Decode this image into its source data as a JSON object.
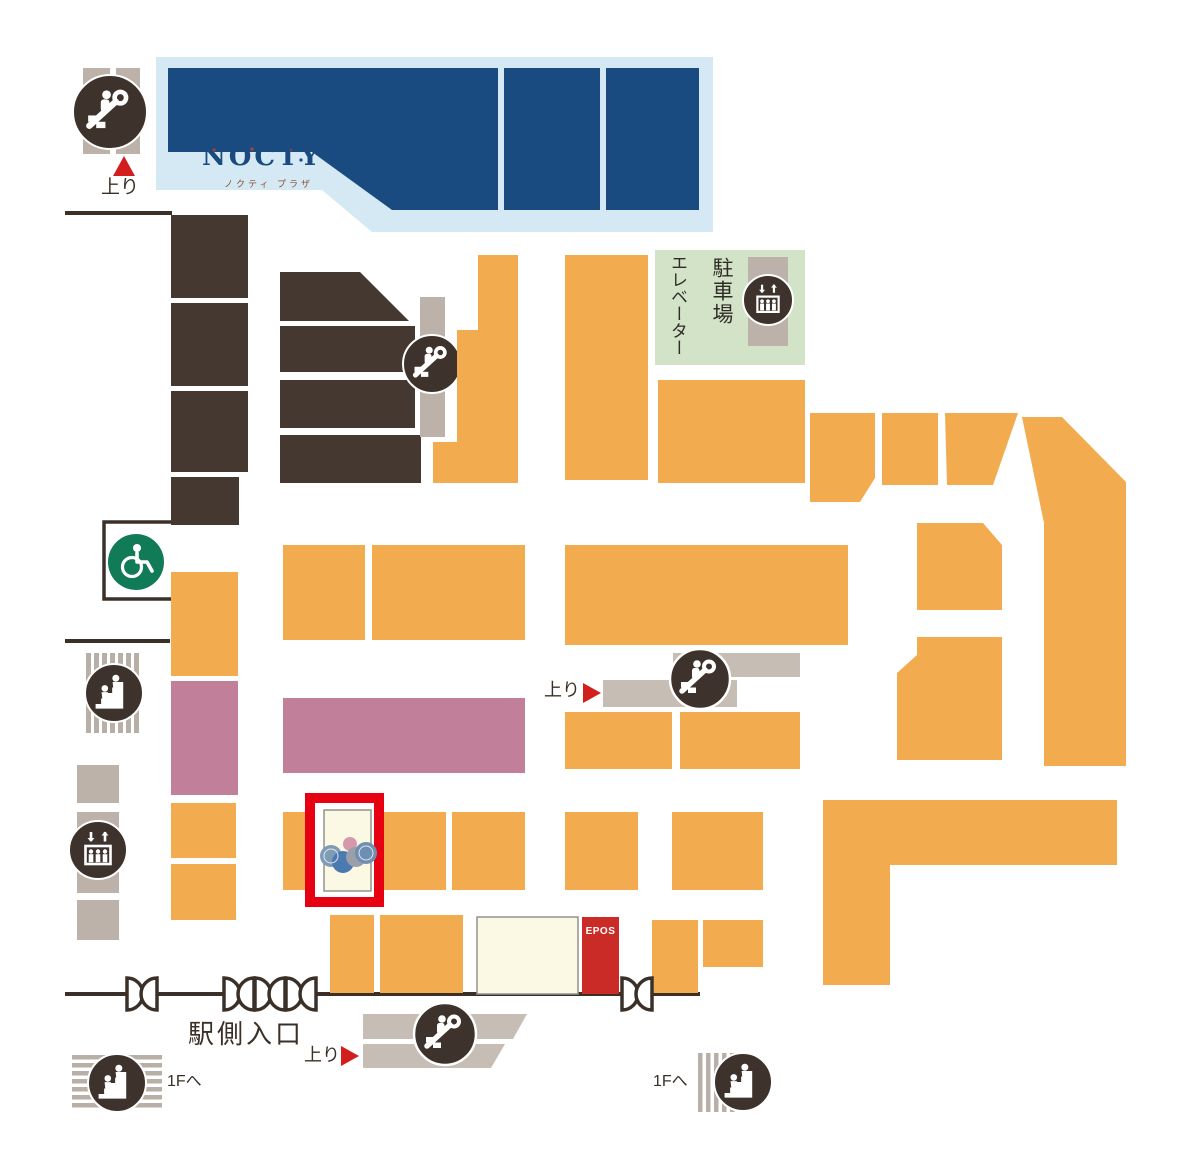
{
  "map": {
    "logo": {
      "name": "NOCTY",
      "subtitle": "ノクティ プラザ"
    },
    "labels": {
      "up": "上り",
      "parking": "駐車場",
      "elevator": "エレベーター",
      "station_entrance": "駅側入口",
      "to_first_floor": "1Fへ",
      "epos": "EPOS"
    },
    "colors": {
      "shop_orange": "#F2AB4F",
      "landmark_navy": "#1A4B80",
      "landmark_light_blue": "#D5E9F4",
      "facility_brown": "#453830",
      "icon_circle_brown": "#3E332C",
      "parking_green": "#D2E3C7",
      "accessible_green": "#117B57",
      "shop_mauve": "#C17F99",
      "corridor_grey": "#BCB2A9",
      "escalator_band_grey": "#C6BDB4",
      "store_cream": "#FBF8E3",
      "epos_red": "#CB2B27",
      "highlight_red": "#E60012",
      "wall_dark": "#3B3028"
    }
  }
}
